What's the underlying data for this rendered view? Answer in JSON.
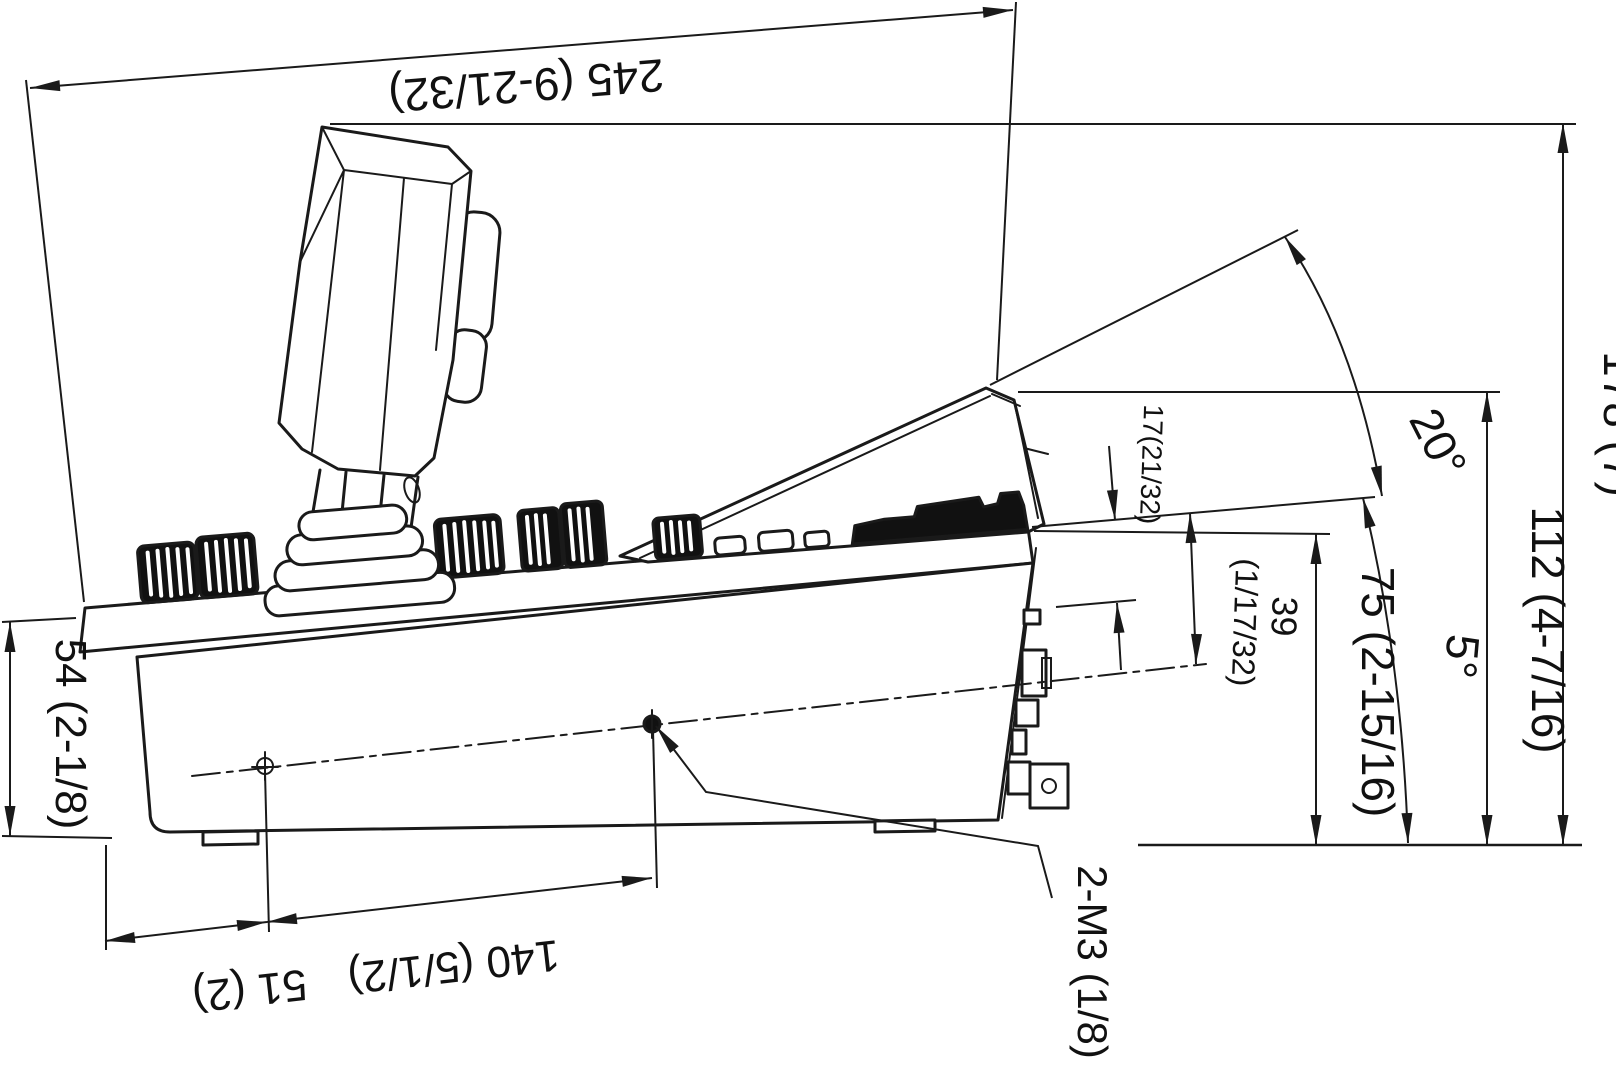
{
  "drawing": {
    "labels": {
      "width_overall": "245 (9-21/32)",
      "height_overall": "178 (7)",
      "height_rear_panel_top": "112 (4-7/16)",
      "height_panel_rear": "75 (2-15/16)",
      "height_front": "54 (2-1/8)",
      "angle_display": "20°",
      "angle_panel": "5°",
      "offset_display": "17(21/32)",
      "height_hole_value": "39",
      "height_hole_fraction": "(1/17/32)",
      "hole_offset_front": "51 (2)",
      "hole_spacing": "140 (5/1/2)",
      "screw_callout": "2-M3 (1/8)"
    }
  }
}
